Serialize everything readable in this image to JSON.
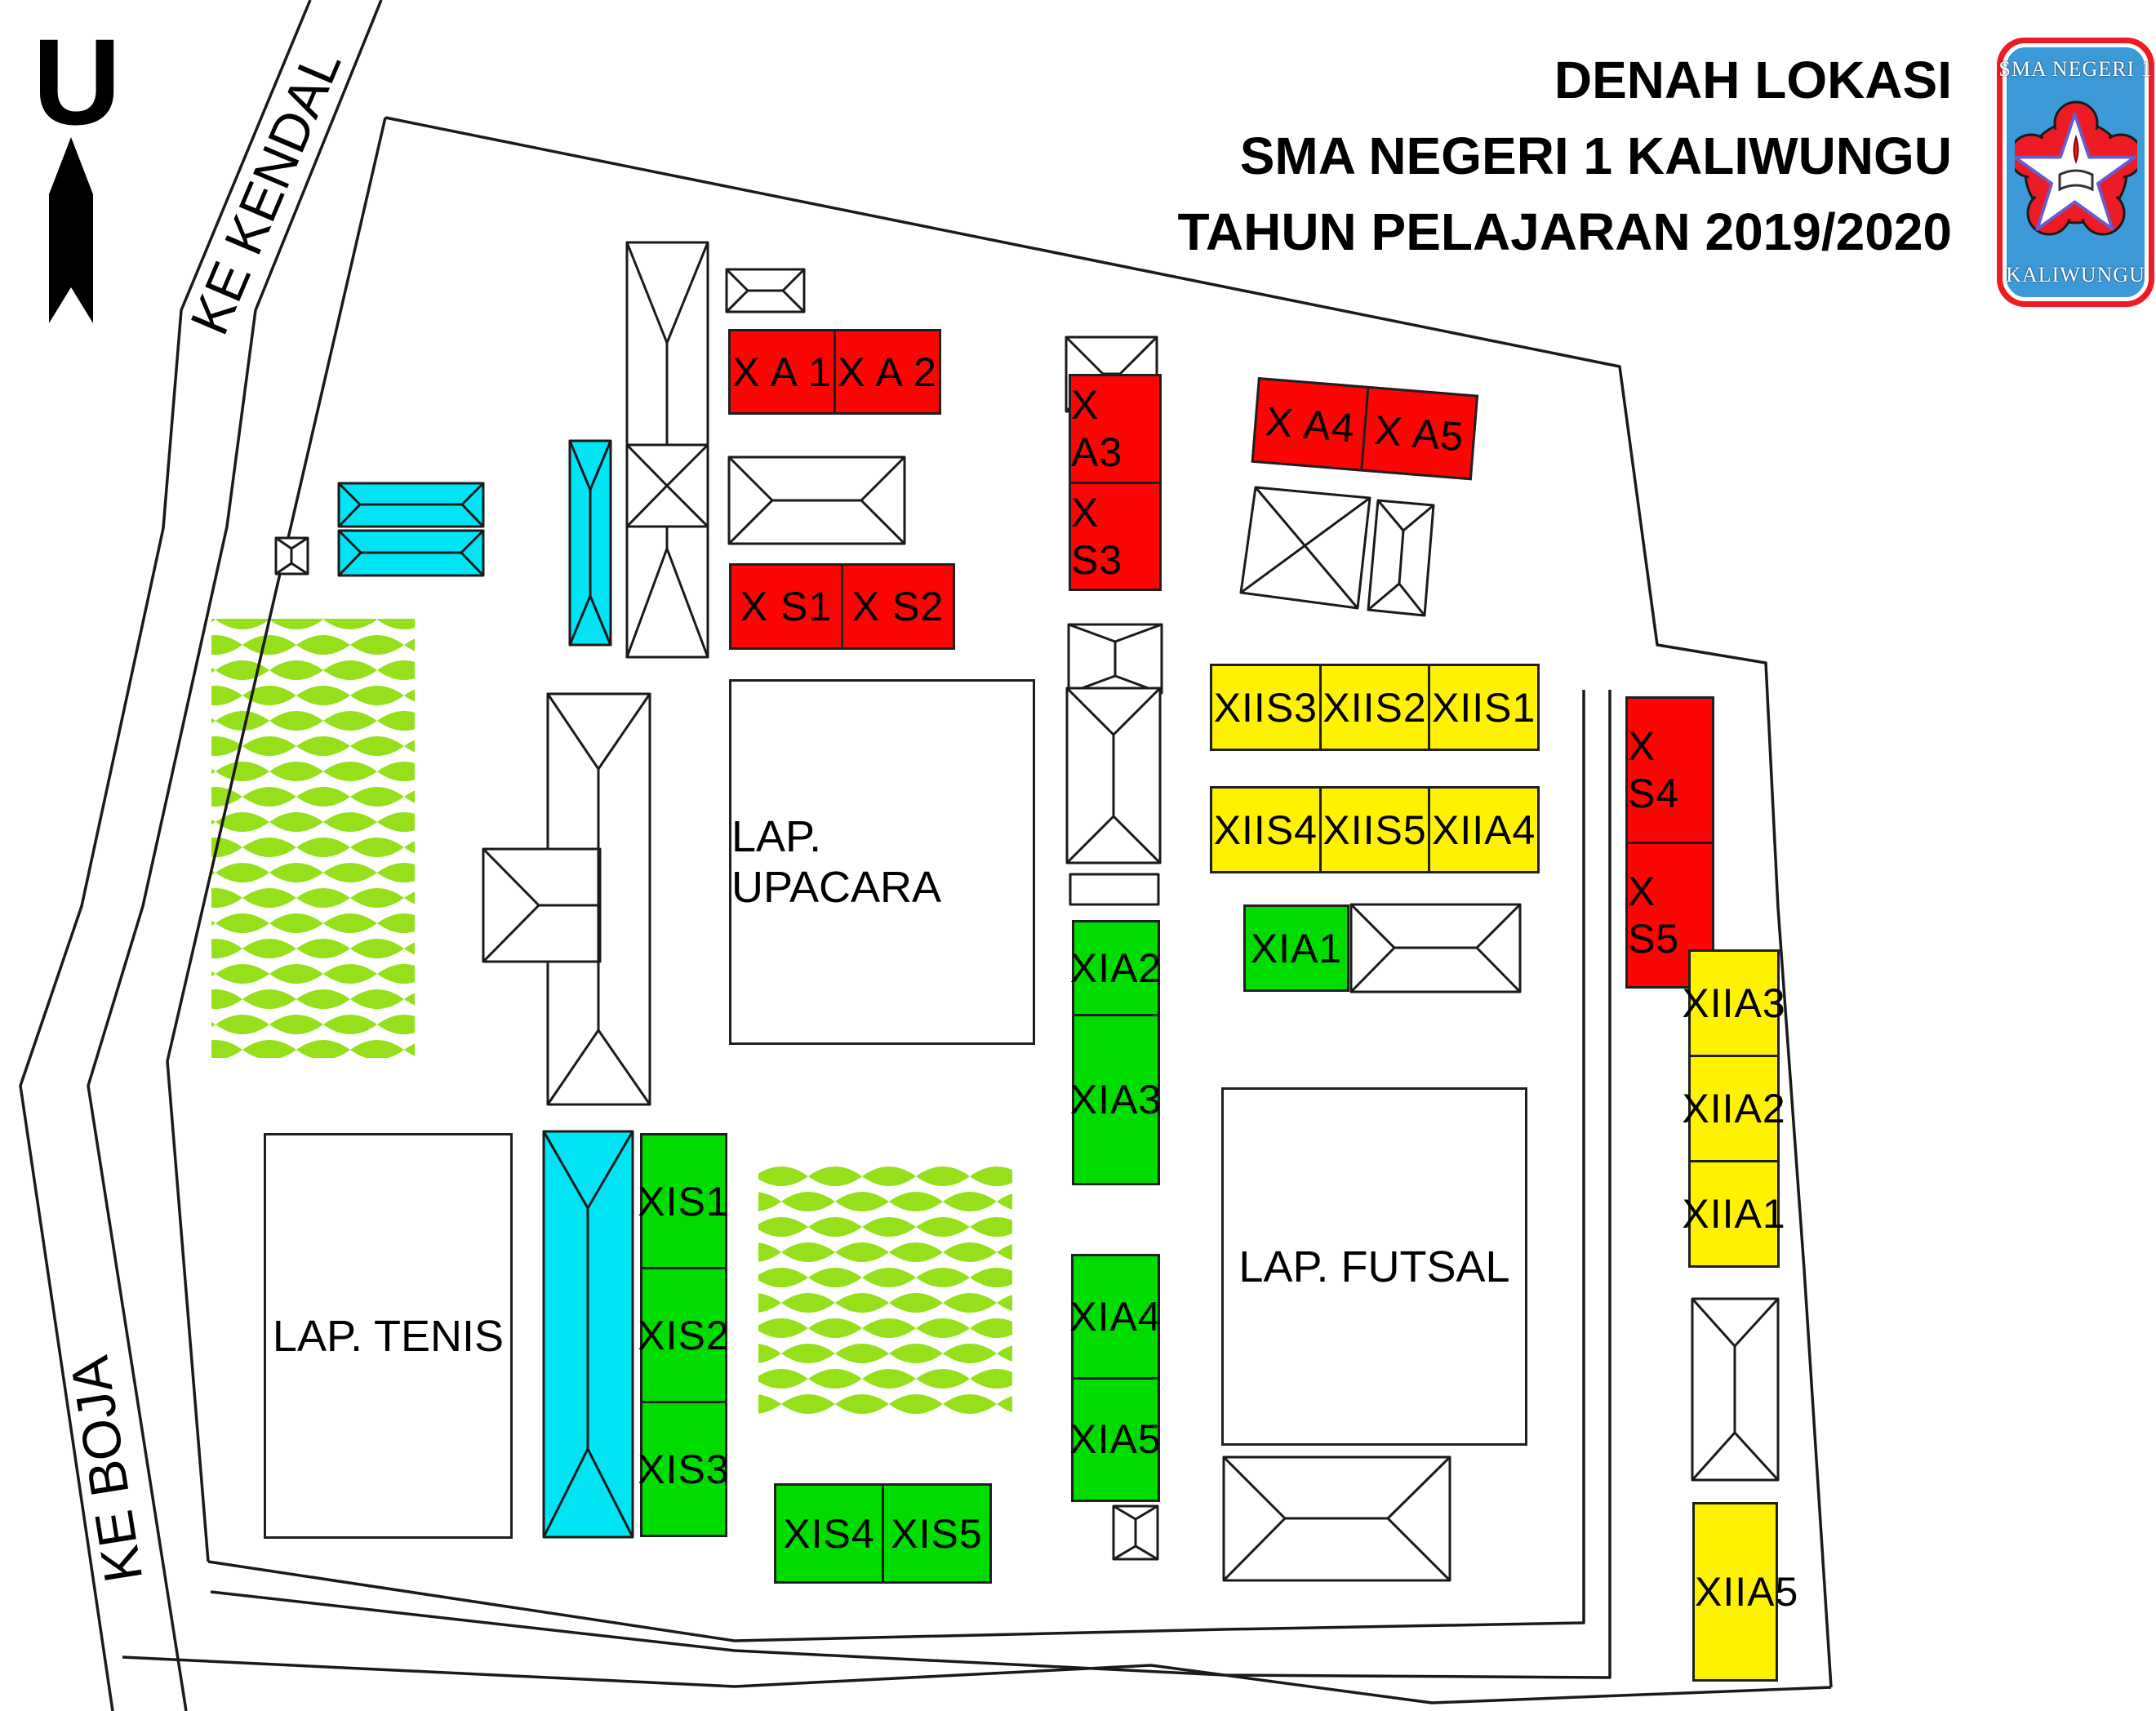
{
  "title": {
    "line1": "DENAH LOKASI",
    "line2": "SMA NEGERI 1 KALIWUNGU",
    "line3": "TAHUN PELAJARAN 2019/2020"
  },
  "logo": {
    "top_text": "SMA NEGERI 1",
    "bottom_text": "KALIWUNGU"
  },
  "compass": {
    "north_label": "U"
  },
  "roads": {
    "north_road": "KE KENDAL",
    "west_road": "KE BOJA"
  },
  "fields": {
    "upacara": "LAP. UPACARA",
    "tenis": "LAP. TENIS",
    "futsal": "LAP. FUTSAL"
  },
  "classrooms": {
    "x_a1": "X A 1",
    "x_a2": "X A 2",
    "x_s1": "X S1",
    "x_s2": "X S2",
    "x_a3": "X A3",
    "x_s3": "X S3",
    "x_a4": "X A4",
    "x_a5": "X A5",
    "x_s4": "X S4",
    "x_s5": "X S5",
    "xiis3": "XIIS3",
    "xiis2": "XIIS2",
    "xiis1": "XIIS1",
    "xiis4": "XIIS4",
    "xiis5": "XIIS5",
    "xiia4": "XIIA4",
    "xia1": "XIA1",
    "xia2": "XIA2",
    "xia3": "XIA3",
    "xia4": "XIA4",
    "xia5": "XIA5",
    "xis1": "XIS1",
    "xis2": "XIS2",
    "xis3": "XIS3",
    "xis4": "XIS4",
    "xis5": "XIS5",
    "xiia3": "XIIA3",
    "xiia2": "XIIA2",
    "xiia1": "XIIA1",
    "xiia5": "XIIA5"
  },
  "colors": {
    "red": "#FB0505",
    "yellow": "#FFF200",
    "green": "#00DC00",
    "cyan": "#00E4F4",
    "leaf": "#95E01A",
    "line": "#1a1a1a",
    "logo_blue": "#3D9AD9",
    "logo_red": "#ED1C24"
  }
}
